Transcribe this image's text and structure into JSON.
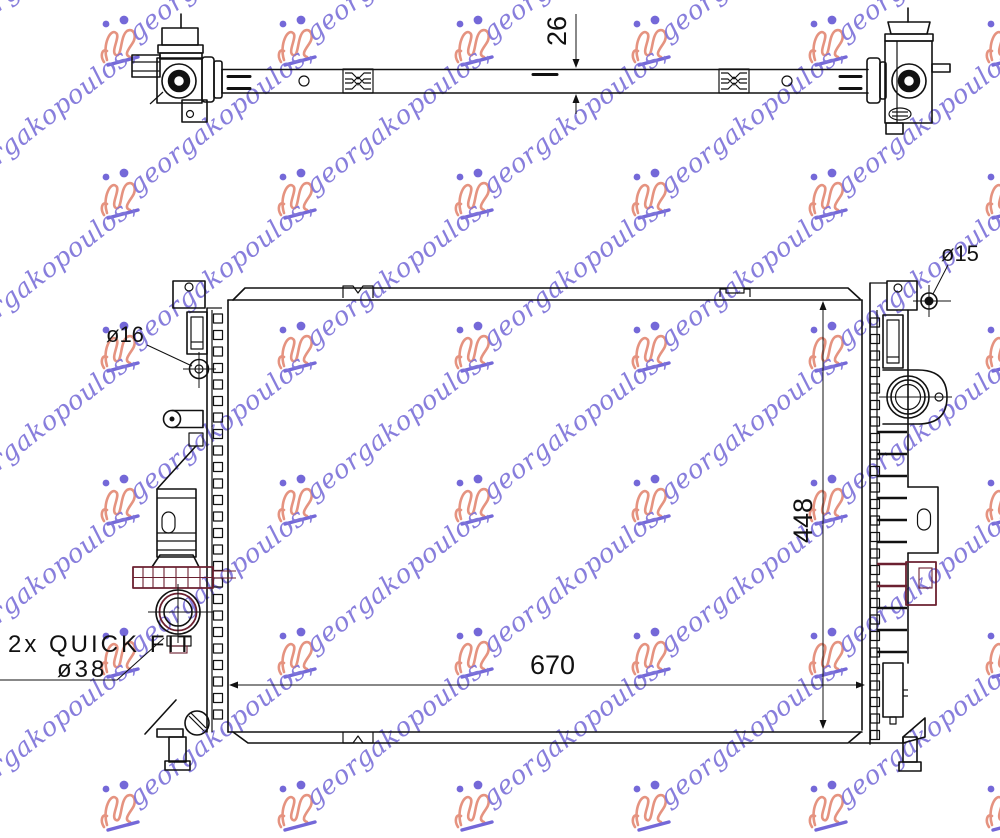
{
  "title": "Radiator technical drawing",
  "labels": {
    "bar_thickness": "26",
    "core_width": "670",
    "core_height": "448",
    "left_port": "ø16",
    "right_port": "ø15",
    "quickfit": "2x  QUICK  FIT",
    "quickfit_dia": "ø38"
  },
  "watermark": {
    "text": "georgakopoulos,",
    "text_color": "#7e74da",
    "logo_color": "#e59380",
    "dot_color": "#7468d8"
  },
  "colors": {
    "line": "#111111",
    "accent": "#6b2030",
    "background": "#ffffff"
  }
}
